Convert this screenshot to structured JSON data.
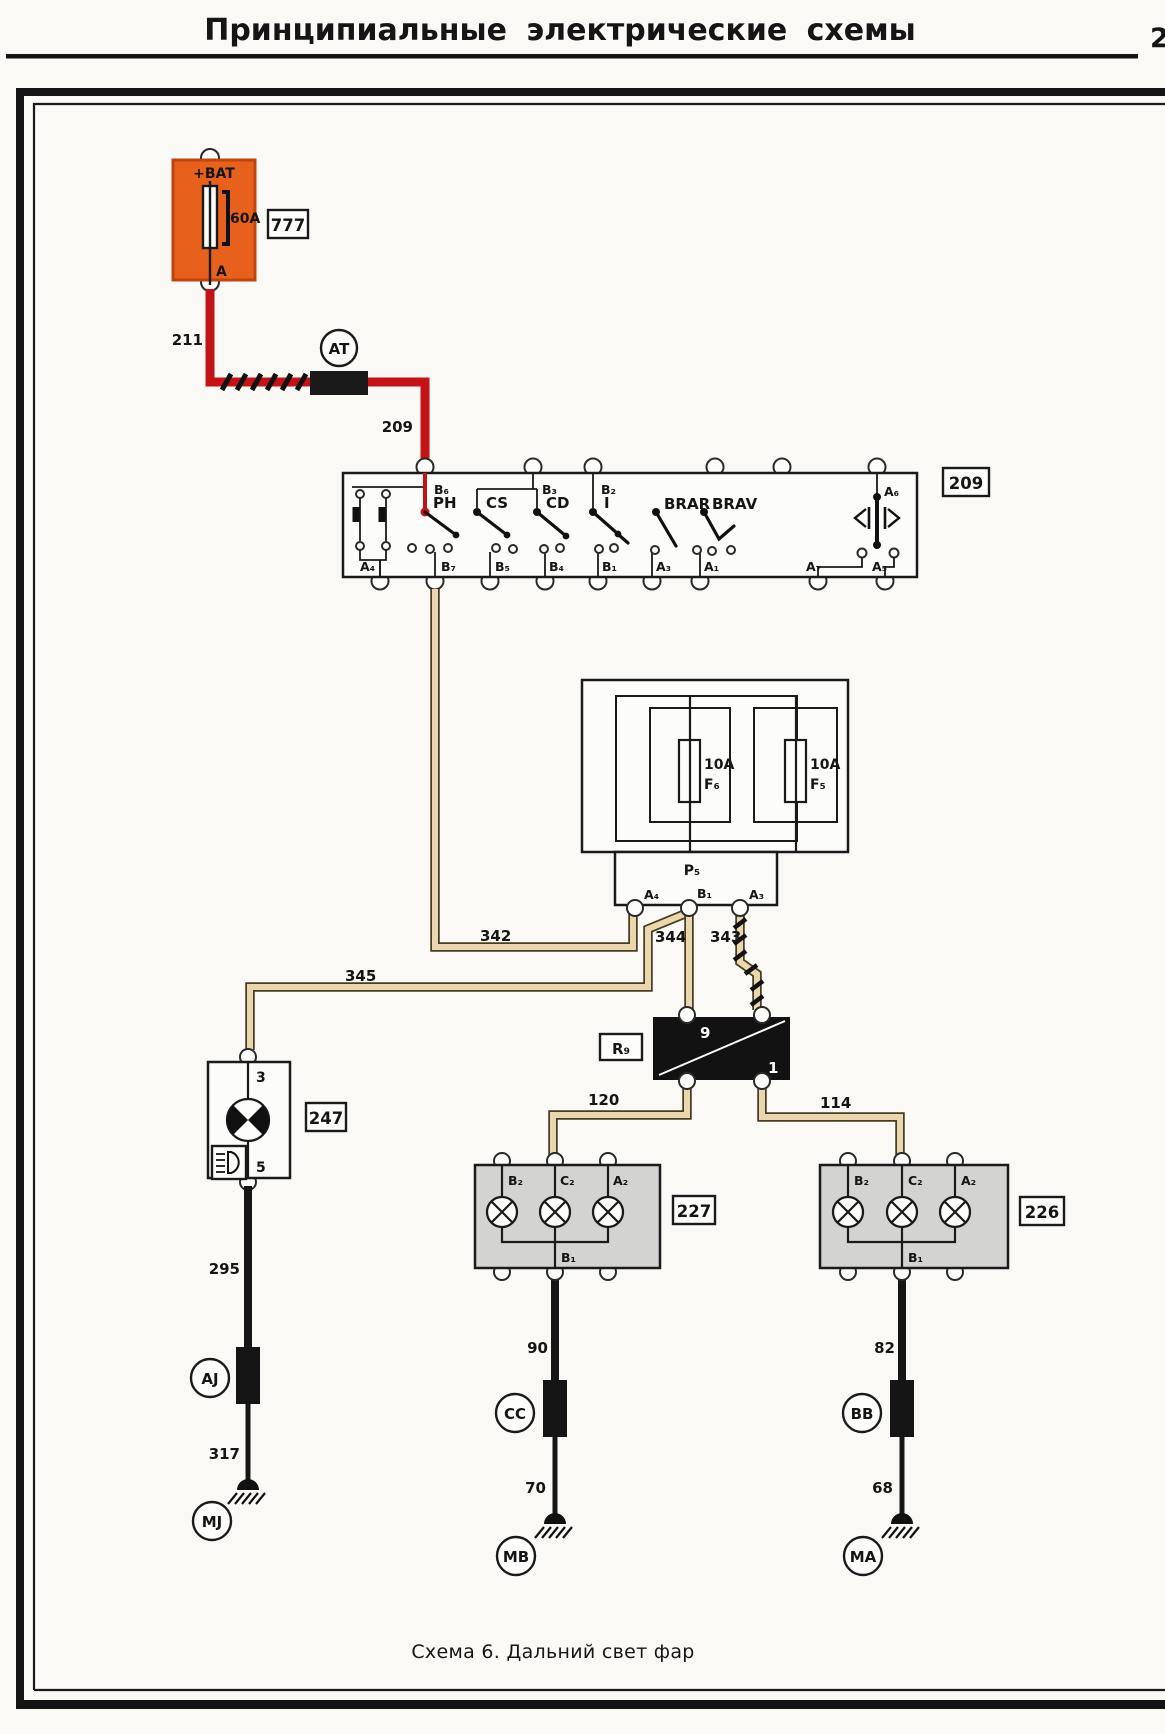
{
  "page": {
    "title": "Принципиальные  электрические  схемы",
    "page_number": "2",
    "caption": "Схема 6. Дальний свет фар"
  },
  "colors": {
    "wire_red": "#c41316",
    "wire_tan": "#ead7b0",
    "battery_box_orange": "#e8611c",
    "headlight_block_gray": "#d3d3d1"
  },
  "battery_fuse": {
    "ref": "777",
    "bat": "+BAT",
    "rating": "60A",
    "out": "A",
    "wire_down": "211"
  },
  "connector_at": "AT",
  "wire_209": "209",
  "switch_block": {
    "ref": "209",
    "top": [
      "B₆",
      "B₃",
      "B₂",
      "A₆"
    ],
    "bottom": [
      "A₄",
      "B₇",
      "B₅",
      "B₄",
      "B₁",
      "A₃",
      "A₁",
      "A₇",
      "A₅"
    ],
    "switches": [
      "PH",
      "CS",
      "CD",
      "I",
      "BRAR",
      "BRAV"
    ]
  },
  "fuse_box": {
    "f6_rating": "10A",
    "f6": "F₆",
    "f5_rating": "10A",
    "f5": "F₅",
    "p5": "P₅",
    "a4": "A₄",
    "b1": "B₁",
    "a3": "A₃"
  },
  "wires_mid": {
    "w342": "342",
    "w344": "344",
    "w343": "343",
    "w345": "345",
    "w120": "120",
    "w114": "114"
  },
  "relay": {
    "ref": "R₉",
    "pin_top": "9",
    "pin_bottom": "1"
  },
  "indicator_247": {
    "ref": "247",
    "t3": "3",
    "t5": "5"
  },
  "headlight_left": {
    "ref": "227",
    "b2": "B₂",
    "c2": "C₂",
    "a2": "A₂",
    "b1": "B₁"
  },
  "headlight_right": {
    "ref": "226",
    "b2": "B₂",
    "c2": "C₂",
    "a2": "A₂",
    "b1": "B₁"
  },
  "chain_left": {
    "w295": "295",
    "conn": "AJ",
    "w317": "317",
    "gnd": "MJ"
  },
  "chain_mid": {
    "w90": "90",
    "conn": "CC",
    "w70": "70",
    "gnd": "MB"
  },
  "chain_right": {
    "w82": "82",
    "conn": "BB",
    "w68": "68",
    "gnd": "MA"
  }
}
